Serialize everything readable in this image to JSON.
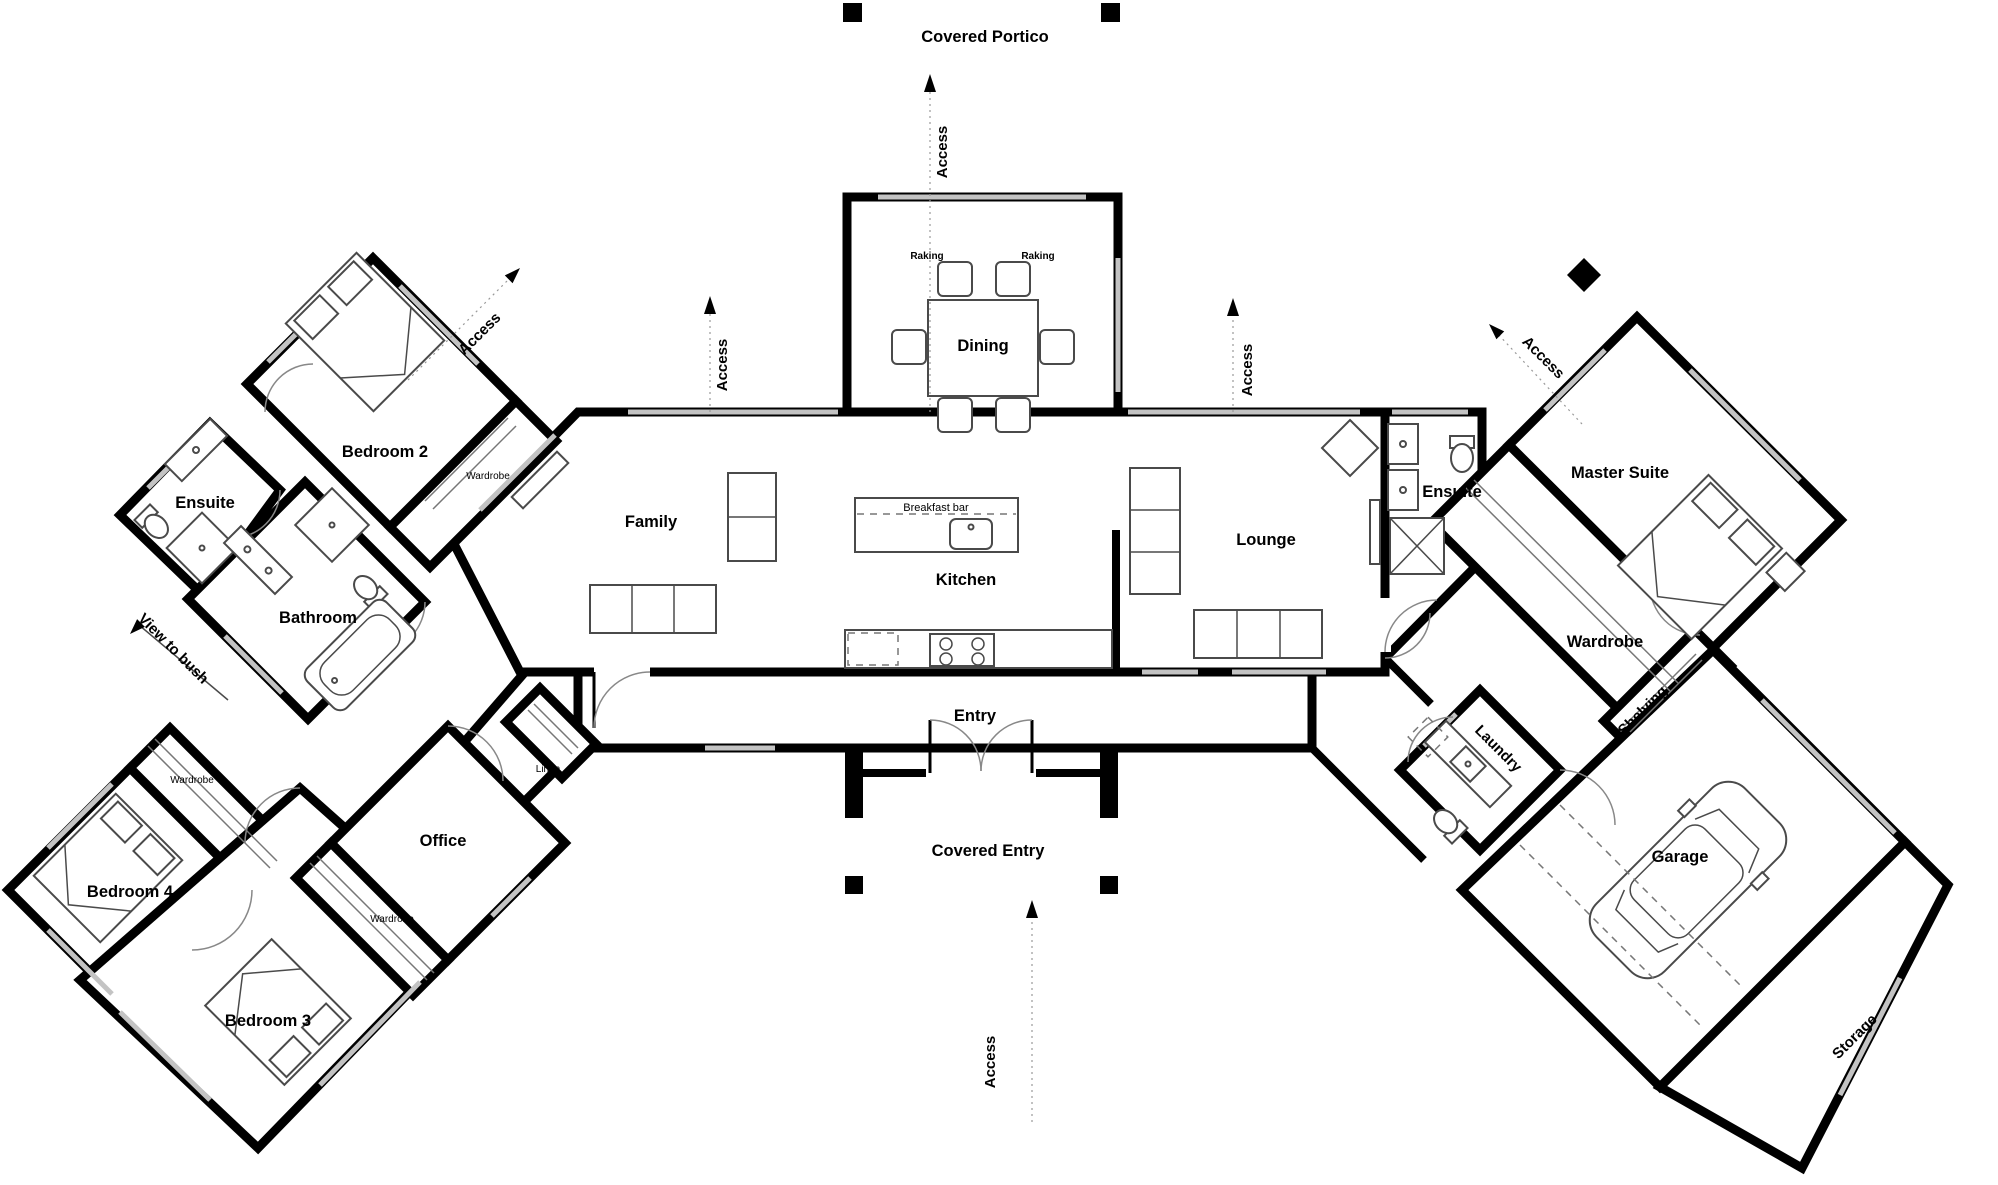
{
  "rooms": {
    "dining": "Dining",
    "family": "Family",
    "kitchen": "Kitchen",
    "lounge": "Lounge",
    "entry": "Entry",
    "master_suite": "Master Suite",
    "ensuite_right": "Ensuite",
    "wardrobe_master": "Wardrobe",
    "laundry": "Laundry",
    "garage": "Garage",
    "storage": "Storage",
    "shelving": "Shelving",
    "bedroom2": "Bedroom 2",
    "ensuite_left": "Ensuite",
    "bathroom": "Bathroom",
    "bedroom3": "Bedroom 3",
    "bedroom4": "Bedroom 4",
    "office": "Office"
  },
  "outdoor": {
    "covered_portico": "Covered Portico",
    "covered_entry": "Covered Entry"
  },
  "annotations": {
    "access": "Access",
    "view_to_bush": "View to bush",
    "raking": "Raking",
    "breakfast_bar": "Breakfast bar",
    "linen": "Linen",
    "wardrobe": "Wardrobe"
  },
  "colors": {
    "walls": "#000000",
    "windows": "#c3c3c3",
    "furniture": "#4a4a4a",
    "background": "#ffffff"
  }
}
